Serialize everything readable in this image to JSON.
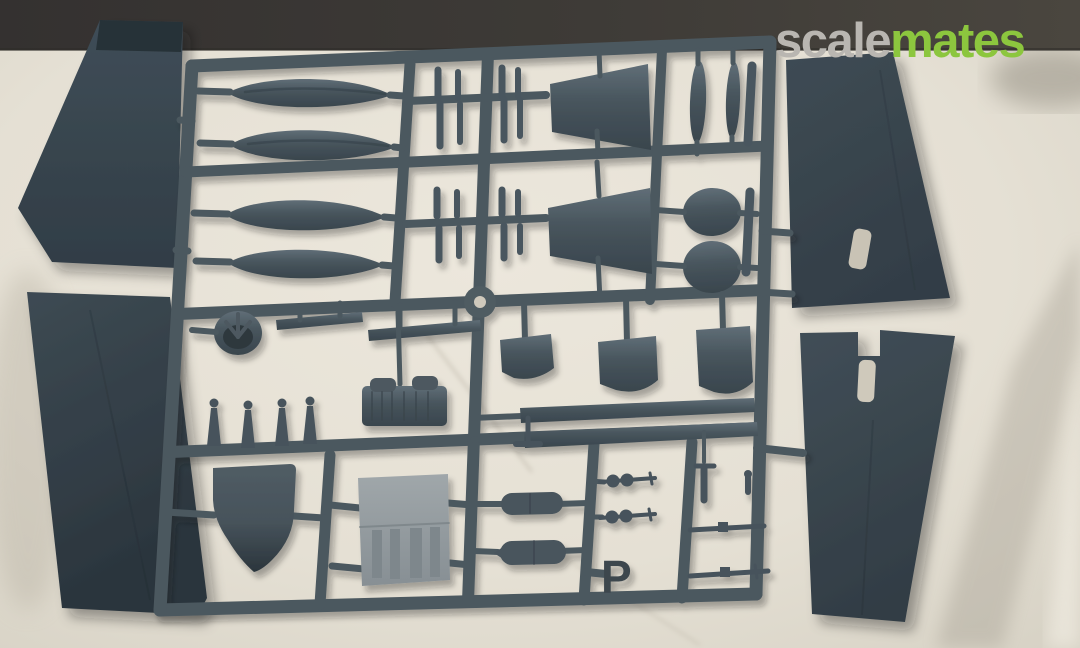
{
  "watermark": {
    "text_gray": "scale",
    "text_green": "mates",
    "gray_color": "#b9b6b1",
    "green_color": "#8cc63e"
  },
  "sprue": {
    "letter": "P",
    "plastic_color": "#49555d",
    "rail_color": "#4c585f",
    "light_panel_color": "#99a0a3"
  },
  "scene": {
    "fabric_color": "#e7e2d7",
    "table_color": "#3b3835",
    "wing_plastic_color": "#3a4750"
  },
  "parts_inventory": {
    "large_wing_panels": 4,
    "float_halves": 4,
    "stabilizer_panels": 2,
    "blade_parts": 2,
    "oval_covers": 2,
    "cowl_domes": 3,
    "bomb_shapes": 4,
    "strut_posts": 8,
    "walkway_strips": 2,
    "machine_guns": 2,
    "cowling_ring": 1,
    "engine_block": 1,
    "windscreen_shield": 1,
    "instrument_panel": 1,
    "cylinder_parts": 2,
    "rod_parts": 2
  }
}
